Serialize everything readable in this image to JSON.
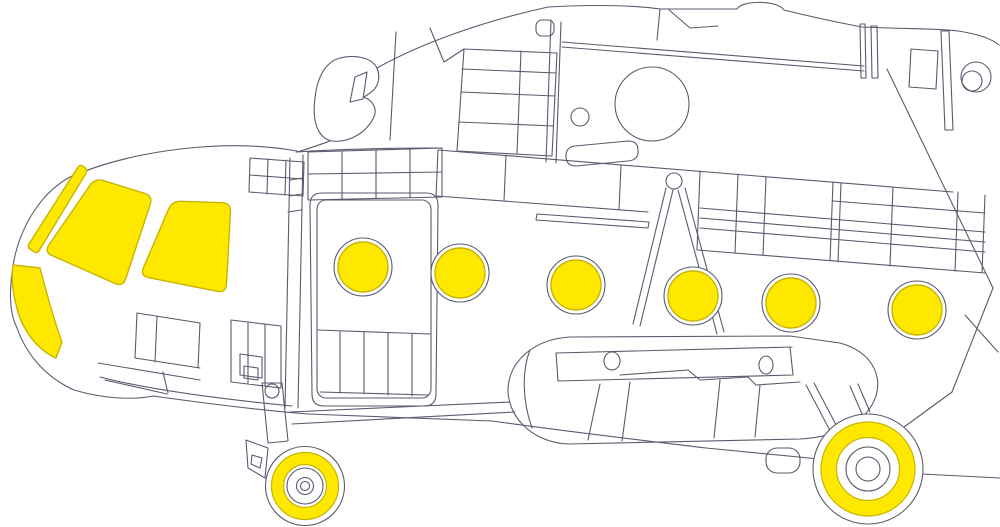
{
  "artwork": {
    "palette": {
      "background": "#ffffff",
      "line": "#5a5a6e",
      "mask_fill": "#ffe800",
      "mask_outline": "#c9b400"
    },
    "cockpit_windows": [
      {
        "name": "windshield-strip-mask",
        "corner_radius": 4,
        "points": [
          [
            80,
            164
          ],
          [
            88,
            170
          ],
          [
            37,
            254
          ],
          [
            27,
            247
          ]
        ]
      },
      {
        "name": "left-windshield-mask",
        "corner_radius": 9,
        "points": [
          [
            95,
            178
          ],
          [
            153,
            196
          ],
          [
            123,
            287
          ],
          [
            44,
            252
          ]
        ]
      },
      {
        "name": "right-windshield-mask",
        "corner_radius": 9,
        "points": [
          [
            172,
            201
          ],
          [
            231,
            203
          ],
          [
            226,
            293
          ],
          [
            140,
            276
          ]
        ]
      },
      {
        "name": "lower-blister-mask",
        "path": "M 13,265 L 40,268 C 47,295 54,320 62,342 L 56,358 C 38,350 24,332 18,312 C 13,295 11,278 13,265 Z"
      }
    ],
    "portholes": [
      {
        "name": "porthole-mask-1",
        "cx": 363,
        "cy": 267,
        "mask_r": 25,
        "ring_r": 29
      },
      {
        "name": "porthole-mask-2",
        "cx": 460,
        "cy": 273,
        "mask_r": 25,
        "ring_r": 29
      },
      {
        "name": "porthole-mask-3",
        "cx": 576,
        "cy": 285,
        "mask_r": 25,
        "ring_r": 29
      },
      {
        "name": "porthole-mask-4",
        "cx": 693,
        "cy": 296,
        "mask_r": 25,
        "ring_r": 29
      },
      {
        "name": "porthole-mask-5",
        "cx": 791,
        "cy": 303,
        "mask_r": 25,
        "ring_r": 29
      },
      {
        "name": "porthole-mask-6",
        "cx": 917,
        "cy": 310,
        "mask_r": 25,
        "ring_r": 29
      }
    ],
    "wheels": [
      {
        "name": "nose-wheel-mask",
        "cx": 305,
        "cy": 486,
        "tire_r": 39.5,
        "ring_outer_r": 33.5,
        "ring_inner_r": 21.5,
        "hub_rings": [
          18,
          8.5,
          4.5
        ]
      },
      {
        "name": "main-wheel-mask",
        "cx": 868,
        "cy": 469,
        "tire_r": 55,
        "ring_outer_r": 47,
        "ring_inner_r": 31.5,
        "hub_rings": [
          22,
          12
        ]
      }
    ]
  }
}
